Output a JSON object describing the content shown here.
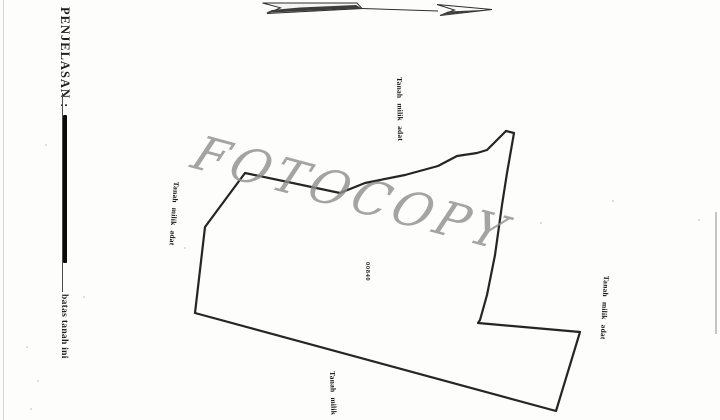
{
  "legend": {
    "title": "PENJELASAN :",
    "items": [
      {
        "symbol": "thick-boundary-line",
        "label": "batas tanah ini"
      }
    ]
  },
  "north_arrow": {
    "icon": "north-arrow-icon"
  },
  "watermark": {
    "text": "FOTOCOPY"
  },
  "parcel": {
    "number": "00840",
    "adjacent": {
      "top": "Tanah milik adat",
      "left": "Tanah milik adat",
      "right": "Tanah milik adat",
      "bottom": "Tanah milik"
    }
  },
  "colors": {
    "ink": "#161616",
    "watermark_gray": "#8e8e8e"
  }
}
